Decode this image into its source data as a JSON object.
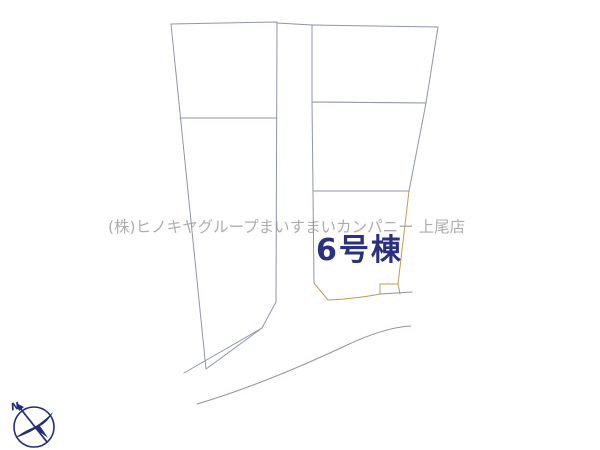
{
  "map": {
    "background": "#ffffff",
    "line_color": "#8f95ac",
    "watermark": {
      "text": "(株)ヒノキヤグループまいすまいカンパニー 上尾店",
      "color": "#969696"
    },
    "highlight_parcel": {
      "label": "6号棟",
      "fill": "#f4d292",
      "label_color": "#2b3181",
      "border_color": "#bf9c55"
    },
    "compass": {
      "label": "N",
      "color": "#232d7a"
    }
  }
}
